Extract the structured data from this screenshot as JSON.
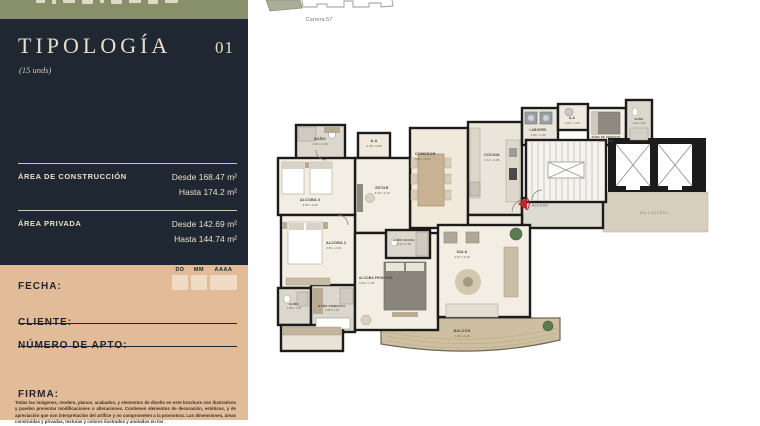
{
  "site": {
    "street_label": "Carrera 57"
  },
  "sidebar": {
    "title": "TIPOLOGÍA",
    "number": "01",
    "units_note": "(15 unds)",
    "construction_area": {
      "label": "ÁREA DE CONSTRUCCIÓN",
      "from": "Desde 168.47 m²",
      "to": "Hasta 174.2 m²"
    },
    "private_area": {
      "label": "ÁREA PRIVADA",
      "from": "Desde 142.69 m²",
      "to": "Hasta 144.74 m²"
    },
    "form": {
      "date_label": "FECHA:",
      "dd": "DD",
      "mm": "MM",
      "aaaa": "AAAA",
      "client_label": "CLIENTE:",
      "apt_label": "NÚMERO DE APTO:",
      "signature_label": "FIRMA:",
      "disclaimer": "Todas las imágenes, renders, planos, acabados, y elementos de diseño en este brochure son ilustrativos y pueden presentar modificaciones o alteraciones. Contienen elementos de decoración, estéticos, y de apreciación que son interpretación del artífice y no comprometen a la promotora. Las dimensiones, áreas construidas y privadas, texturas y colores ilustrados y anotados en los"
    }
  },
  "plan": {
    "access_label": "ACCESO",
    "hall_label": "HALL ACCESO",
    "rooms": [
      {
        "name": "BAÑO",
        "dims": "2.40 x 1.60"
      },
      {
        "name": "A.A",
        "dims": "3.48 x 0.88"
      },
      {
        "name": "COMEDOR",
        "dims": "3.48 x 4.13"
      },
      {
        "name": "ESTAR",
        "dims": "3.43 x 3.13"
      },
      {
        "name": "ALCOBA 3",
        "dims": "3.65 x 3.00"
      },
      {
        "name": "COCINA",
        "dims": "3.11 x 4.06"
      },
      {
        "name": "LABORES",
        "dims": "1.60 x 1.30"
      },
      {
        "name": "A.A",
        "dims": "1.00 x 1.06"
      },
      {
        "name": "ZONA DE SERVICIO",
        "dims": "2.10 x 2.31"
      },
      {
        "name": "BAÑO",
        "dims": "1.26 x 2.06"
      },
      {
        "name": "BAÑO SOCIAL",
        "dims": "2.10 x 1.36"
      },
      {
        "name": "ALCOBA 2",
        "dims": "3.65 x 3.20"
      },
      {
        "name": "BAÑO",
        "dims": "1.90 x 1.35"
      },
      {
        "name": "BAÑO PRINCIPAL",
        "dims": "3.30 x 2.10"
      },
      {
        "name": "ALCOBA PRINCIPAL",
        "dims": "3.40 x 3.35"
      },
      {
        "name": "SALA",
        "dims": "4.57 x 3.33"
      },
      {
        "name": "BALCÓN",
        "dims": "7.40 x 1.30"
      }
    ]
  },
  "colors": {
    "brand_green": "#879069",
    "brand_navy": "#1f2832",
    "brand_cream": "#e8decb",
    "brand_tan": "#e2bc98",
    "accent_red": "#c0272d"
  }
}
